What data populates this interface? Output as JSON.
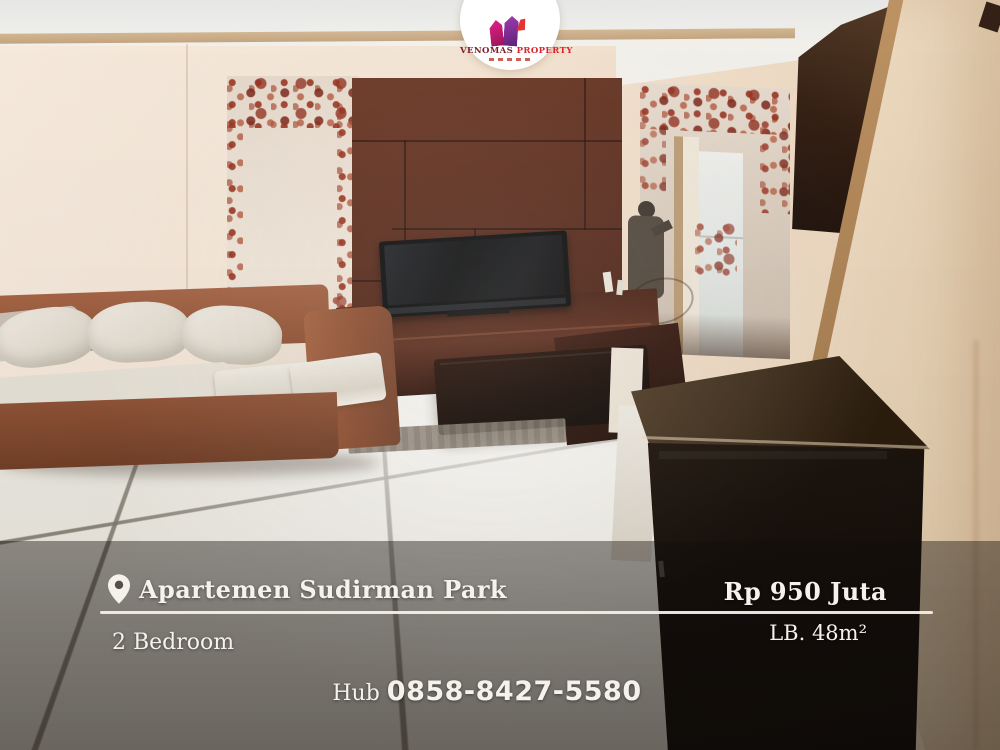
{
  "logo": {
    "name_part1": "VENOMAS",
    "name_part2": "PROPERTY"
  },
  "captions": {
    "location": "Apartemen Sudirman Park",
    "price": "Rp 950 Juta",
    "bedrooms": "2 Bedroom",
    "area": "LB. 48m²",
    "contact_label": "Hub",
    "contact_number": "0858-8427-5580"
  },
  "colors": {
    "caption_text": "#f5f2ec",
    "divider": "#f2efe8",
    "overlay_band": "rgba(18,14,10,0.46)",
    "logo_maroon": "#7e1f2d",
    "logo_red": "#d9252b",
    "tv_wall": "#54261a",
    "cabinet": "#0d0806",
    "sofa": "#9a5a3e",
    "wall": "#f2e4d4"
  }
}
